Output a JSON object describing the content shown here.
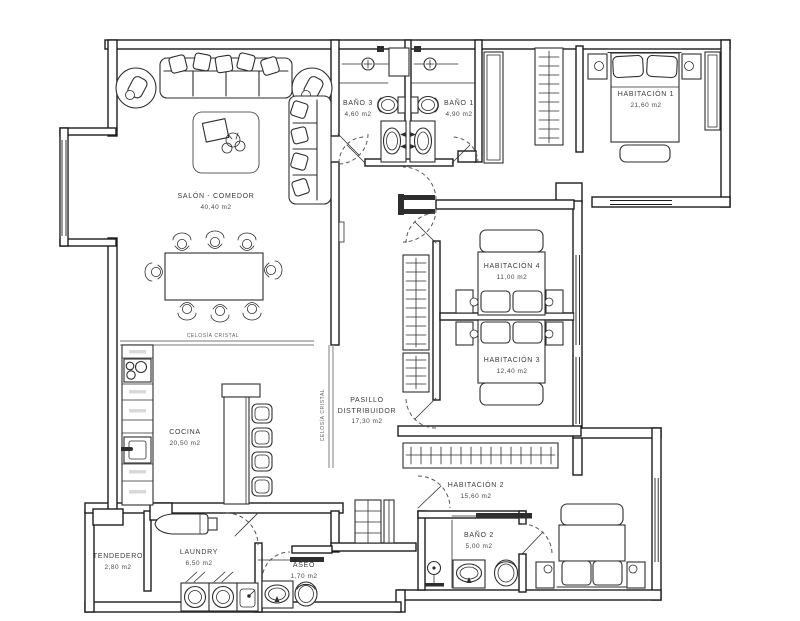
{
  "drawing": {
    "type": "architectural floor plan",
    "units_note": "areas in m2",
    "colors": {
      "walls": "#1c1c1c",
      "furniture": "#2e2e2e",
      "glass_partition": "#949494",
      "background": "#ffffff"
    }
  },
  "rooms": [
    {
      "id": "salon",
      "name": "SALÓN - COMEDOR",
      "name2": "",
      "area": "40,40 m2",
      "fixtures": "sofa, armchairs, chaise sofa, rug, coffee table, dining table for 8"
    },
    {
      "id": "bano3",
      "name": "BAÑO 3",
      "name2": "",
      "area": "4,60 m2",
      "fixtures": "shower, toilet, washbasin"
    },
    {
      "id": "bano1",
      "name": "BAÑO 1",
      "name2": "",
      "area": "4,90 m2",
      "fixtures": "shower, toilet, washbasin"
    },
    {
      "id": "habitacion1",
      "name": "HABITACIÓN 1",
      "name2": "",
      "area": "21,60 m2",
      "fixtures": "double bed, nightstands, bench, wardrobes"
    },
    {
      "id": "habitacion4",
      "name": "HABITACIÓN 4",
      "name2": "",
      "area": "11,00 m2",
      "fixtures": "bed, nightstands, wardrobe"
    },
    {
      "id": "habitacion3",
      "name": "HABITACIÓN 3",
      "name2": "",
      "area": "12,40 m2",
      "fixtures": "bed, nightstands, wardrobe"
    },
    {
      "id": "pasillo",
      "name": "PASILLO",
      "name2": "DISTRIBUIDOR",
      "area": "17,30 m2",
      "fixtures": "hall closets, double door"
    },
    {
      "id": "cocina",
      "name": "COCINA",
      "name2": "",
      "area": "20,50 m2",
      "fixtures": "cooktop, sink, cabinet run, island with 4 stools"
    },
    {
      "id": "habitacion2",
      "name": "HABITACIÓN 2",
      "name2": "",
      "area": "15,60 m2",
      "fixtures": "double bed, nightstands, long wardrobe, shelving"
    },
    {
      "id": "tendedero",
      "name": "TENDEDERO",
      "name2": "",
      "area": "2,80 m2",
      "fixtures": ""
    },
    {
      "id": "laundry",
      "name": "LAUNDRY",
      "name2": "",
      "area": "6,50 m2",
      "fixtures": "washer, dryer, sink, ironing board"
    },
    {
      "id": "aseo",
      "name": "ASEO",
      "name2": "",
      "area": "1,70 m2",
      "fixtures": "washbasin, toilet, towel rail"
    },
    {
      "id": "bano2",
      "name": "BAÑO 2",
      "name2": "",
      "area": "5,00 m2",
      "fixtures": "shower, washbasin, toilet, towel rail"
    }
  ],
  "annotations": {
    "celosia_horizontal": "CELOSÍA CRISTAL",
    "celosia_vertical": "CELOSÍA CRISTAL"
  }
}
